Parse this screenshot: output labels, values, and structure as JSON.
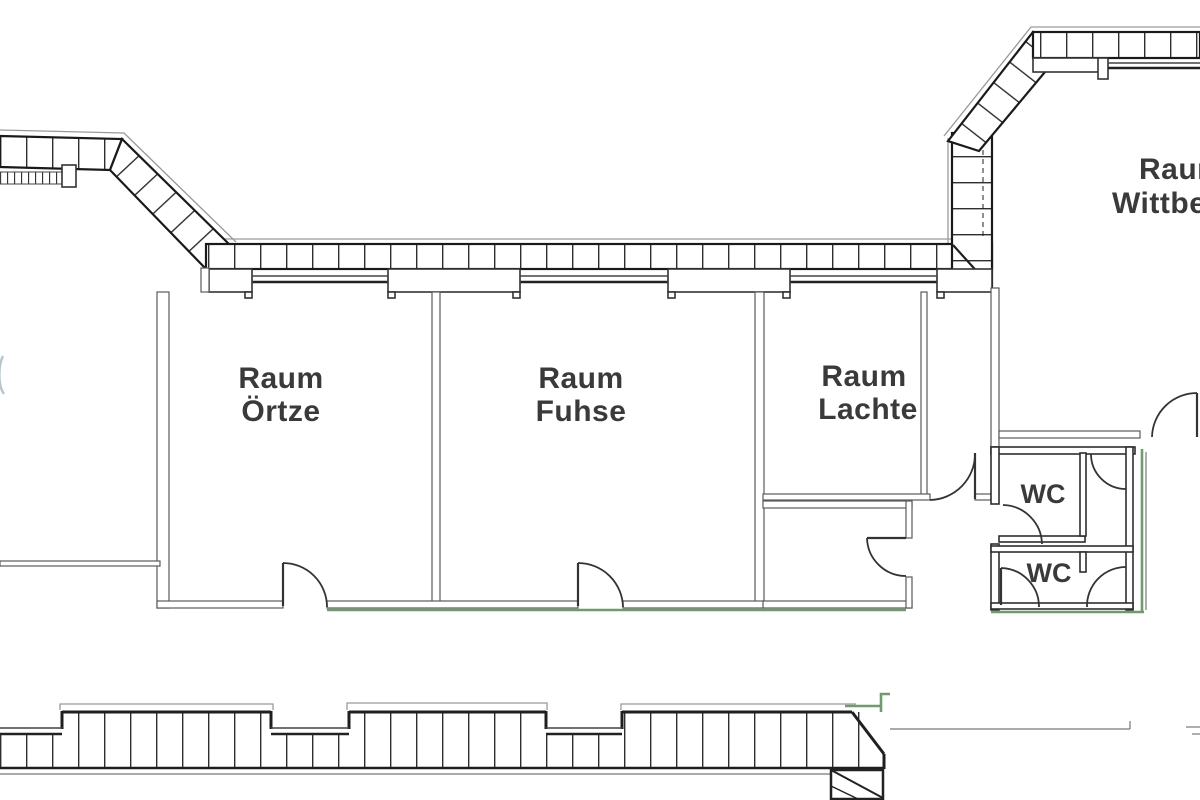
{
  "rooms": {
    "oertze": {
      "line1": "Raum",
      "line2": "Örtze"
    },
    "fuhse": {
      "line1": "Raum",
      "line2": "Fuhse"
    },
    "lachte": {
      "line1": "Raum",
      "line2": "Lachte"
    },
    "wittbeck": {
      "line1": "Raum",
      "line2": "Wittbec"
    },
    "wc_top": {
      "label": "WC"
    },
    "wc_bottom": {
      "label": "WC"
    }
  },
  "colors": {
    "wall_dark": "#1f1f1f",
    "wall_gray": "#5a5a5a",
    "outline_light": "#9a9a9a",
    "accent_green": "#6f9b6f",
    "text": "#3a3a3a",
    "background": "#ffffff"
  }
}
